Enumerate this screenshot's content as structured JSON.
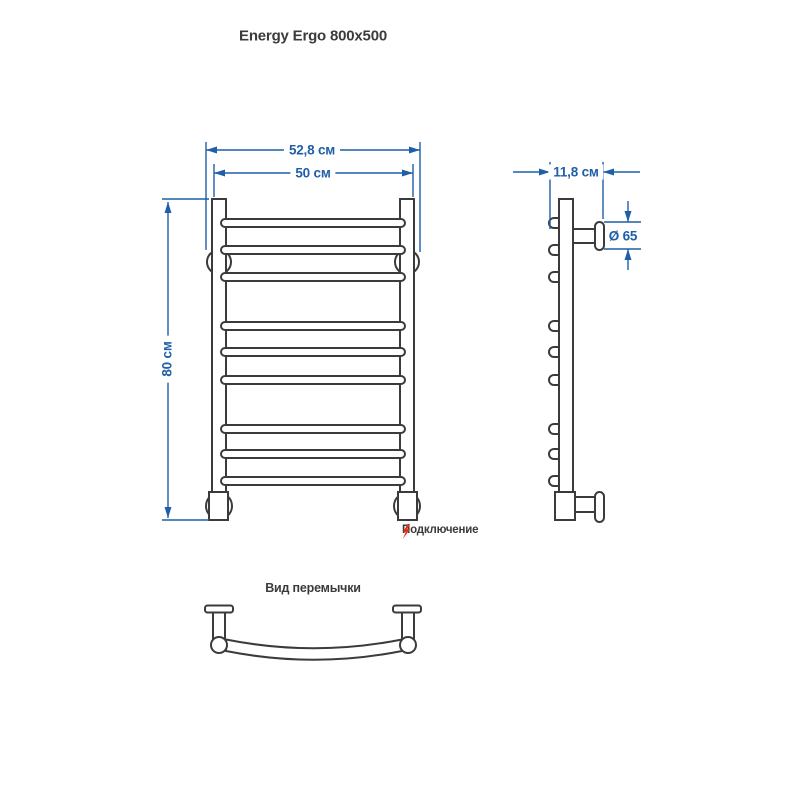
{
  "title": "Energy Ergo 800x500",
  "front_view": {
    "outer_width": "52,8 см",
    "inner_width": "50 см",
    "height": "80 см",
    "rung_count": 9,
    "rung_groups": 3
  },
  "side_view": {
    "depth": "11,8 см",
    "bracket_diameter": "Ø 65"
  },
  "connection": {
    "label": "Подключение",
    "icon": "lightning-icon"
  },
  "bridge_view": {
    "title": "Вид перемычки"
  },
  "colors": {
    "dimension_blue": "#1f5fa8",
    "drawing_line": "#3b3b3d",
    "accent_red": "#df3321",
    "background": "#ffffff"
  }
}
